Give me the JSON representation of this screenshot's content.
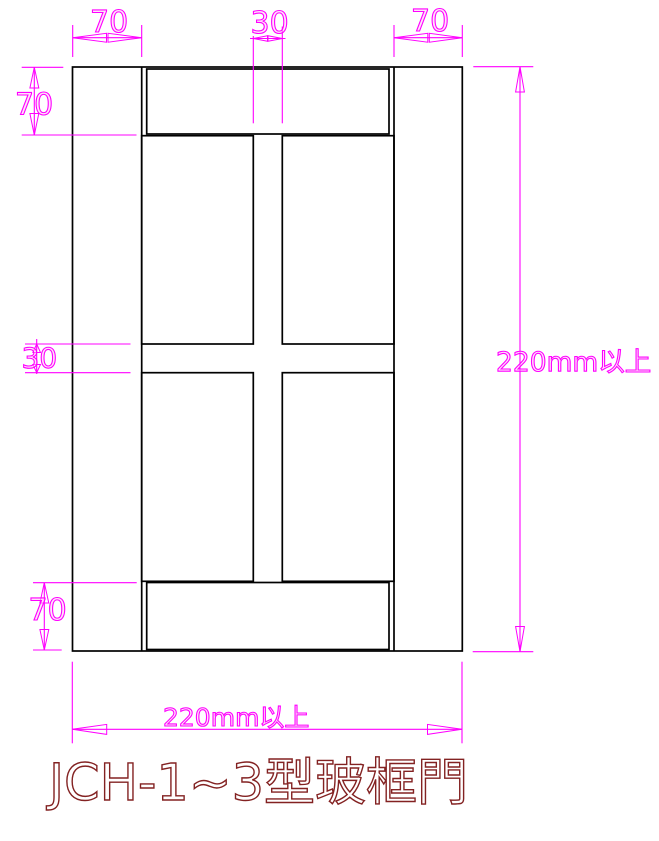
{
  "title": {
    "label": "JCH-1~3型玻框門",
    "color": "#832222"
  },
  "drawing": {
    "type": "door-elevation",
    "outline_color": "#000000",
    "dimension_color": "#ff00ff",
    "panel_count": 4
  },
  "dims": {
    "top_left_stile_width": "70",
    "top_mullion_width": "30",
    "top_right_stile_width": "70",
    "left_top_rail_height": "70",
    "left_mid_rail_height": "30",
    "left_bottom_rail_height": "70",
    "door_height_min": "220mm以上",
    "door_width_min": "220mm以上"
  }
}
